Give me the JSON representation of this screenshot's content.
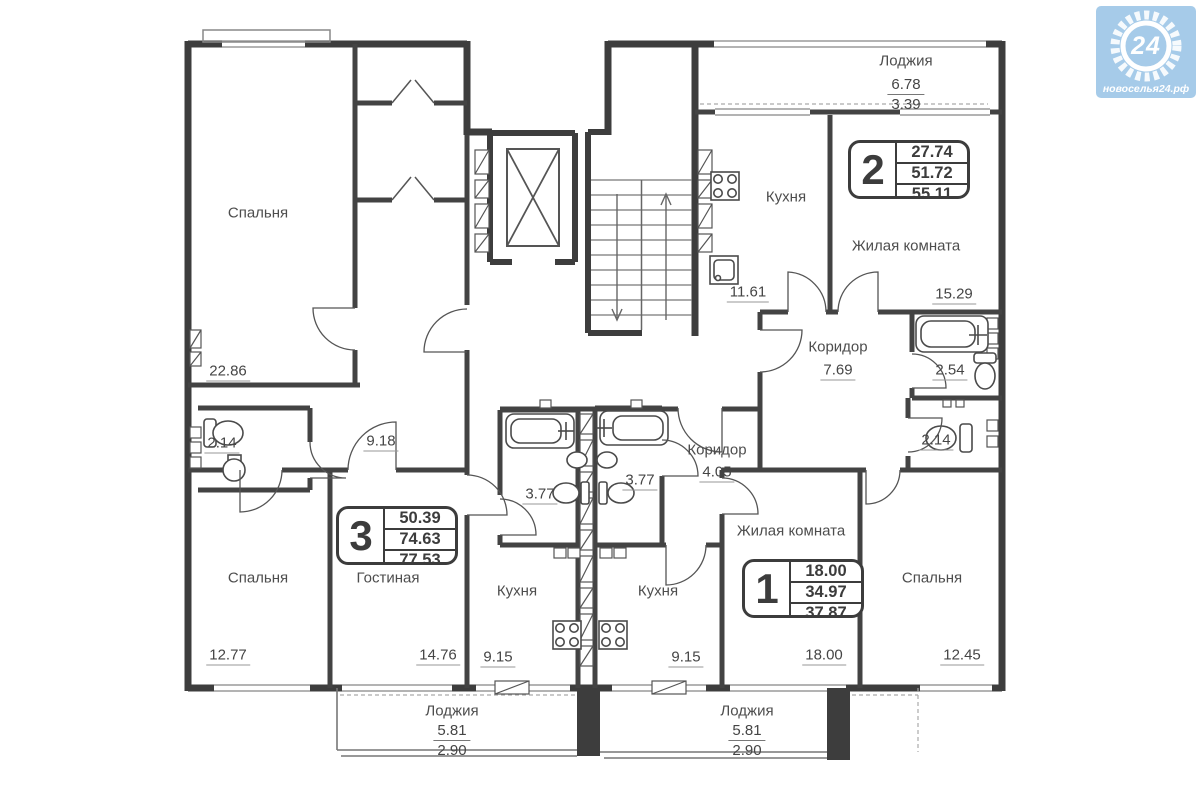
{
  "logo": {
    "number": "24",
    "site": "новоселья24.рф"
  },
  "apartments": [
    {
      "id": "2",
      "living_area": "27.74",
      "area": "51.72",
      "total_area": "55.11"
    },
    {
      "id": "3",
      "living_area": "50.39",
      "area": "74.63",
      "total_area": "77.53"
    },
    {
      "id": "1",
      "living_area": "18.00",
      "area": "34.97",
      "total_area": "37.87"
    }
  ],
  "rooms": [
    {
      "label": "Спальня",
      "area": "22.86"
    },
    {
      "label": "Кухня",
      "area": "11.61"
    },
    {
      "label": "Жилая комната",
      "area": "15.29"
    },
    {
      "label": "Коридор",
      "area": "7.69"
    },
    {
      "label": "",
      "area": "2.54"
    },
    {
      "label": "",
      "area": "2.14"
    },
    {
      "label": "",
      "area": "9.18"
    },
    {
      "label": "",
      "area": "3.77"
    },
    {
      "label": "",
      "area": "3.77"
    },
    {
      "label": "Коридор",
      "area": "4.05"
    },
    {
      "label": "Спальня",
      "area": "12.77"
    },
    {
      "label": "Гостиная",
      "area": "14.76"
    },
    {
      "label": "Кухня",
      "area": "9.15"
    },
    {
      "label": "Кухня",
      "area": "9.15"
    },
    {
      "label": "Жилая комната",
      "area": "18.00"
    },
    {
      "label": "Спальня",
      "area": "12.45"
    },
    {
      "label": "",
      "area": "2.14"
    }
  ],
  "loggias": [
    {
      "label": "Лоджия",
      "area": "6.78",
      "half_area": "3.39"
    },
    {
      "label": "Лоджия",
      "area": "5.81",
      "half_area": "2.90"
    },
    {
      "label": "Лоджия",
      "area": "5.81",
      "half_area": "2.90"
    }
  ],
  "colors": {
    "wall": "#3d3d3d",
    "logo_bg": "#a6cbe9"
  }
}
